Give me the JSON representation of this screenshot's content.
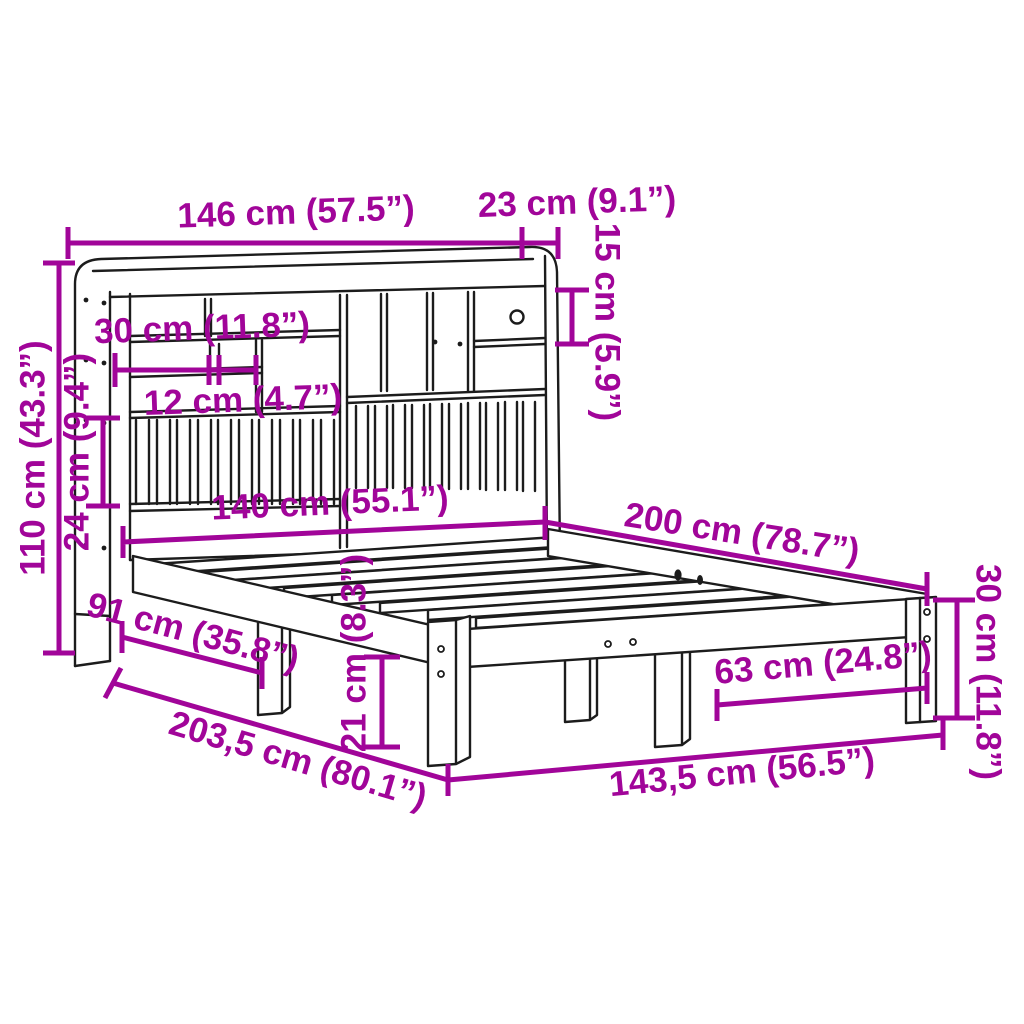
{
  "diagram": {
    "type": "product-dimension-diagram",
    "subject": "bookcase-headboard-bed-frame",
    "units": "cm (inches)",
    "colors": {
      "annotation": "#A10599",
      "linework": "#1C1C1C",
      "background": "#FFFFFF"
    }
  },
  "labels": {
    "headboard_width": "146 cm (57.5”)",
    "headboard_depth": "23 cm (9.1”)",
    "drawer_height": "15 cm (5.9”)",
    "shelf_width": "30 cm (11.8”)",
    "cubby_width": "12 cm (4.7”)",
    "total_height": "110 cm (43.3”)",
    "slat_panel_height": "24 cm (9.4”)",
    "bed_inner_width": "140 cm (55.1”)",
    "bed_length": "200 cm (78.7”)",
    "frame_height": "30 cm (11.8”)",
    "underbed_length": "91 cm (35.8”)",
    "underbed_clearance": "21 cm (8.3”)",
    "leg_spacing": "63 cm (24.8”)",
    "total_length": "203,5 cm (80.1”)",
    "frame_outer_width": "143,5 cm (56.5”)"
  }
}
